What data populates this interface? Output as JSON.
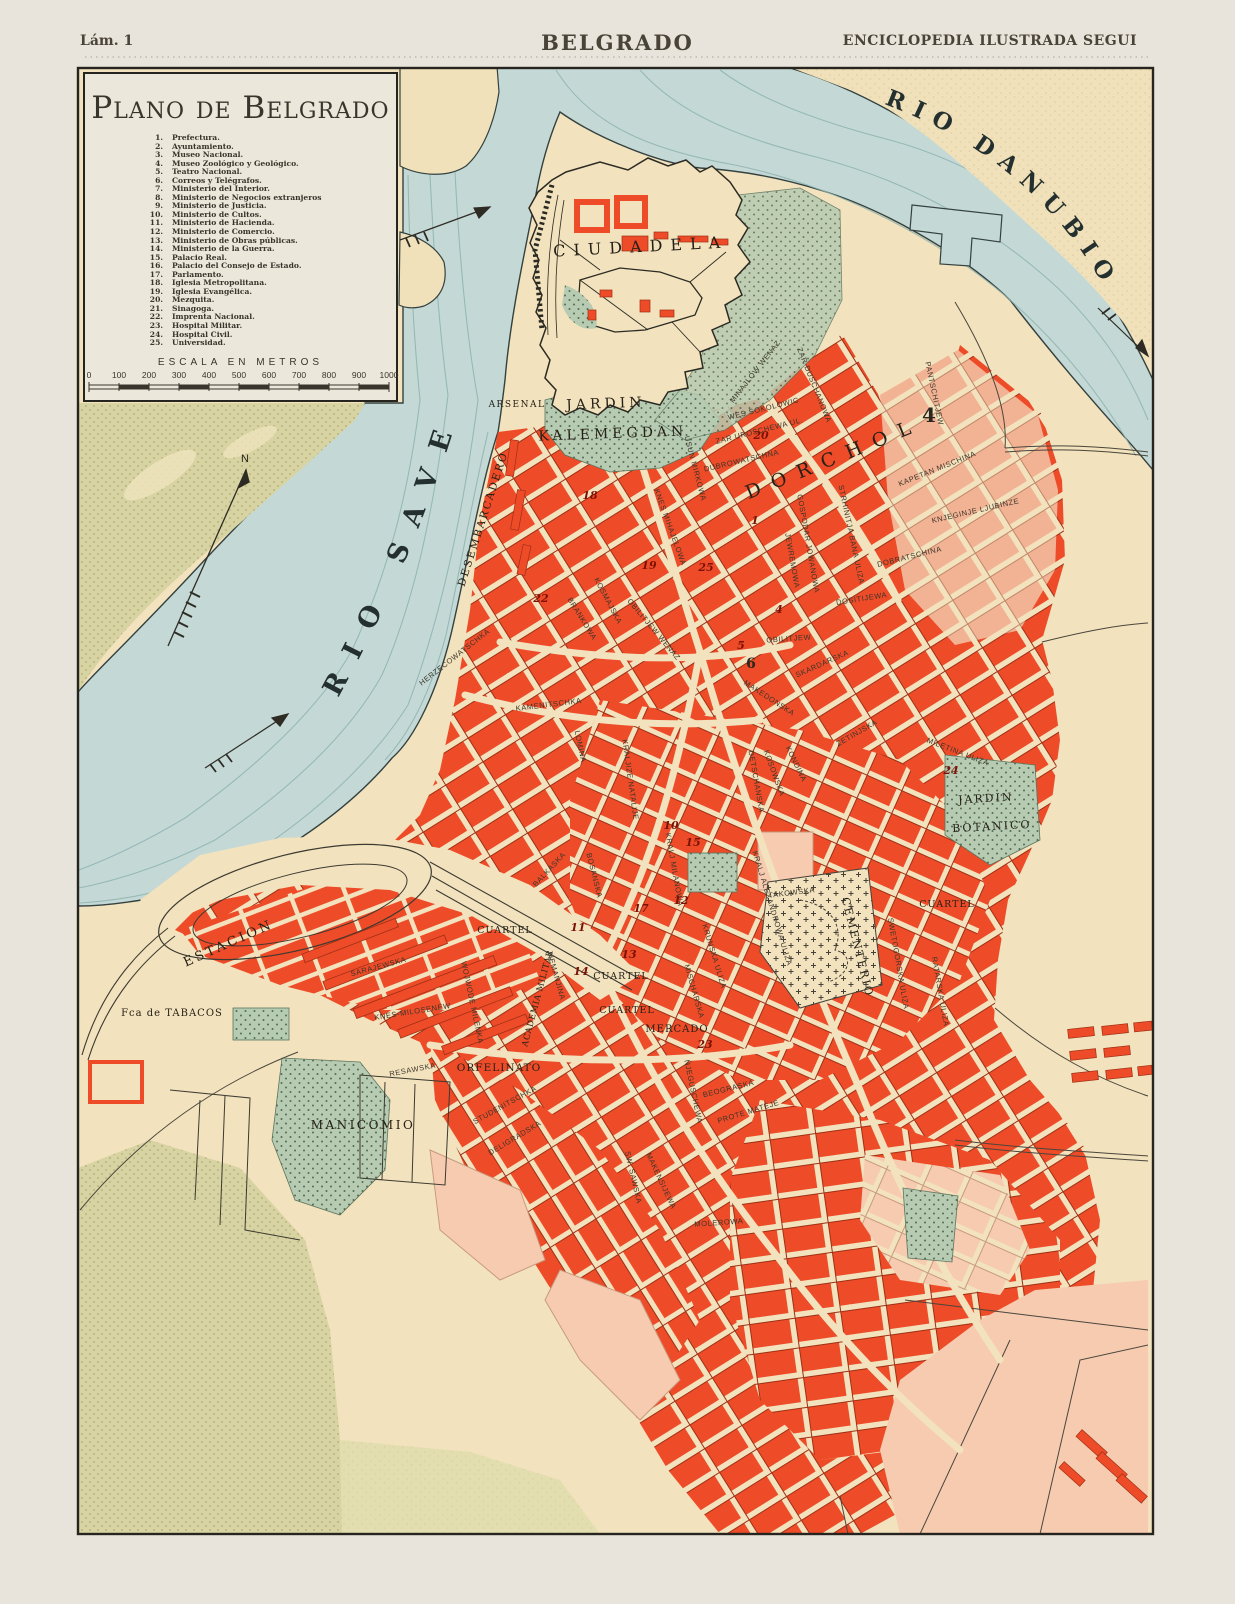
{
  "header": {
    "plate_label": "Lám. 1",
    "title": "BELGRADO",
    "publisher": "ENCICLOPEDIA ILUSTRADA SEGUI"
  },
  "legend": {
    "title": "Plano de Belgrado",
    "scale_title": "ESCALA EN METROS",
    "scale_ticks": [
      "0",
      "100",
      "200",
      "300",
      "400",
      "500",
      "600",
      "700",
      "800",
      "900",
      "1000"
    ],
    "items": [
      {
        "n": "1.",
        "t": "Prefectura."
      },
      {
        "n": "2.",
        "t": "Ayuntamiento."
      },
      {
        "n": "3.",
        "t": "Museo Nacional."
      },
      {
        "n": "4.",
        "t": "Museo Zoológico y Geológico."
      },
      {
        "n": "5.",
        "t": "Teatro Nacional."
      },
      {
        "n": "6.",
        "t": "Correos y Telégrafos."
      },
      {
        "n": "7.",
        "t": "Ministerio del Interior."
      },
      {
        "n": "8.",
        "t": "Ministerio de Negocios extranjeros"
      },
      {
        "n": "9.",
        "t": "Ministerio de Justicia."
      },
      {
        "n": "10.",
        "t": "Ministerio de Cultos."
      },
      {
        "n": "11.",
        "t": "Ministerio de Hacienda."
      },
      {
        "n": "12.",
        "t": "Ministerio de Comercio."
      },
      {
        "n": "13.",
        "t": "Ministerio de Obras públicas."
      },
      {
        "n": "14.",
        "t": "Ministerio de la Guerra."
      },
      {
        "n": "15.",
        "t": "Palacio Real."
      },
      {
        "n": "16.",
        "t": "Palacio del Consejo de Estado."
      },
      {
        "n": "17.",
        "t": "Parlamento."
      },
      {
        "n": "18.",
        "t": "Iglesia Metropolitana."
      },
      {
        "n": "19.",
        "t": "Iglesia Evangélica."
      },
      {
        "n": "20.",
        "t": "Mezquita."
      },
      {
        "n": "21.",
        "t": "Sinagoga."
      },
      {
        "n": "22.",
        "t": "Imprenta Nacional."
      },
      {
        "n": "23.",
        "t": "Hospital Militar."
      },
      {
        "n": "24.",
        "t": "Hospital Civil."
      },
      {
        "n": "25.",
        "t": "Universidad."
      }
    ]
  },
  "map": {
    "river_names": {
      "sava": "RIO SAVE",
      "danubio": "RIO DANUBIO"
    },
    "compass_north": "N",
    "colors": {
      "paper": "#e9e4db",
      "plate_land": "#f2e2bd",
      "water": "#c4d9d6",
      "water_line": "#8fb3b1",
      "block_red": "#ee4b28",
      "block_pink": "#f2b394",
      "block_pink_light": "#f6cbb0",
      "floodplain_olive": "#d8d3a2",
      "park_green": "#b5c9b0",
      "ink": "#26241e",
      "marker_red": "#7c1206"
    },
    "labels": [
      {
        "c": "p",
        "t": "CIUDADELA",
        "x": 641,
        "y": 252,
        "r": -3,
        "s": 16,
        "ls": 8
      },
      {
        "c": "p",
        "t": "ARSENAL",
        "x": 517,
        "y": 407,
        "r": 0,
        "s": 9,
        "ls": 1.5
      },
      {
        "c": "p",
        "t": "JARDIN",
        "x": 606,
        "y": 408,
        "r": -2,
        "s": 14,
        "ls": 4
      },
      {
        "c": "p",
        "t": "KALEMEGDAN",
        "x": 613,
        "y": 438,
        "r": -2,
        "s": 14,
        "ls": 4
      },
      {
        "c": "p",
        "t": "DESEMBARCADERO",
        "x": 486,
        "y": 520,
        "r": -72,
        "s": 10.5,
        "ls": 2
      },
      {
        "c": "p",
        "t": "ESTACION",
        "x": 230,
        "y": 947,
        "r": -24,
        "s": 13,
        "ls": 3
      },
      {
        "c": "p",
        "t": "Fca de TABACOS",
        "x": 172,
        "y": 1016,
        "r": 0,
        "s": 10,
        "ls": 1
      },
      {
        "c": "p",
        "t": "MANICOMIO",
        "x": 363,
        "y": 1129,
        "r": 0,
        "s": 12,
        "ls": 2.5
      },
      {
        "c": "p",
        "t": "ORFELINATO",
        "x": 499,
        "y": 1071,
        "r": 0,
        "s": 10.5,
        "ls": 1
      },
      {
        "c": "p",
        "t": "CUARTEL",
        "x": 505,
        "y": 933,
        "r": 0,
        "s": 9.5,
        "ls": 1
      },
      {
        "c": "p",
        "t": "CUARTEL",
        "x": 621,
        "y": 979,
        "r": 0,
        "s": 9.5,
        "ls": 1
      },
      {
        "c": "p",
        "t": "CUARTEL",
        "x": 627,
        "y": 1013,
        "r": 0,
        "s": 9.5,
        "ls": 1
      },
      {
        "c": "p",
        "t": "CUARTEL",
        "x": 947,
        "y": 907,
        "r": 0,
        "s": 9.5,
        "ls": 1
      },
      {
        "c": "p",
        "t": "MERCADO",
        "x": 677,
        "y": 1032,
        "r": 0,
        "s": 10,
        "ls": 1
      },
      {
        "c": "p",
        "t": "ACADEMIA MILITAR",
        "x": 540,
        "y": 999,
        "r": -75,
        "s": 8.5,
        "ls": 0.5
      },
      {
        "c": "p",
        "t": "CEMENTERIO",
        "x": 854,
        "y": 948,
        "r": 76,
        "s": 11,
        "ls": 2
      },
      {
        "c": "p",
        "t": "JARDIN",
        "x": 986,
        "y": 802,
        "r": -3,
        "s": 11,
        "ls": 2
      },
      {
        "c": "p",
        "t": "BOTANICO",
        "x": 992,
        "y": 830,
        "r": -3,
        "s": 11,
        "ls": 2
      },
      {
        "c": "p",
        "t": "DORCHOL",
        "x": 836,
        "y": 464,
        "r": -22,
        "s": 19,
        "ls": 12
      },
      {
        "c": "s",
        "t": "ZAR UROSCHEWA UL.",
        "x": 760,
        "y": 433,
        "r": -14
      },
      {
        "c": "s",
        "t": "DUBROWATSCHNA",
        "x": 742,
        "y": 463,
        "r": -13
      },
      {
        "c": "s",
        "t": "WES SOKOLOWIC",
        "x": 764,
        "y": 411,
        "r": -14
      },
      {
        "c": "s",
        "t": "ZAR DUSCHANOWA",
        "x": 812,
        "y": 386,
        "r": 68
      },
      {
        "c": "s",
        "t": "MINAJLOW WENAZ",
        "x": 757,
        "y": 373,
        "r": -52
      },
      {
        "c": "s",
        "t": "USUN MIRKOWA",
        "x": 693,
        "y": 469,
        "r": 75
      },
      {
        "c": "s",
        "t": "KNES MIHAJELOWA",
        "x": 668,
        "y": 528,
        "r": 70
      },
      {
        "c": "s",
        "t": "STRHINITJA BANA ULIZA",
        "x": 849,
        "y": 535,
        "r": 78
      },
      {
        "c": "s",
        "t": "GOSPODAR JOWANOWA",
        "x": 806,
        "y": 544,
        "r": 80
      },
      {
        "c": "s",
        "t": "JEWREMOWA",
        "x": 790,
        "y": 561,
        "r": 80
      },
      {
        "c": "s",
        "t": "KAPETAN MISCHINA",
        "x": 938,
        "y": 471,
        "r": -22
      },
      {
        "c": "s",
        "t": "PANTSCHITJEW",
        "x": 932,
        "y": 394,
        "r": 78
      },
      {
        "c": "s",
        "t": "KNJEGINJE LJUBINZE",
        "x": 976,
        "y": 513,
        "r": -13
      },
      {
        "c": "s",
        "t": "DOBRATSCHINA",
        "x": 910,
        "y": 559,
        "r": -14
      },
      {
        "c": "s",
        "t": "DOSITIJEWA",
        "x": 862,
        "y": 601,
        "r": -9
      },
      {
        "c": "s",
        "t": "OBILITJEW",
        "x": 789,
        "y": 641,
        "r": -4
      },
      {
        "c": "s",
        "t": "OBILITJEW WENAZ",
        "x": 652,
        "y": 631,
        "r": 50
      },
      {
        "c": "s",
        "t": "MAKEDONSKA",
        "x": 768,
        "y": 700,
        "r": 33
      },
      {
        "c": "s",
        "t": "KOSOWSKA",
        "x": 772,
        "y": 774,
        "r": 70
      },
      {
        "c": "s",
        "t": "KONDINA",
        "x": 794,
        "y": 765,
        "r": 64
      },
      {
        "c": "s",
        "t": "DETSCHANSKA",
        "x": 754,
        "y": 782,
        "r": 80
      },
      {
        "c": "s",
        "t": "ZETINJSKA",
        "x": 858,
        "y": 735,
        "r": -30
      },
      {
        "c": "s",
        "t": "SKARDARSKA",
        "x": 823,
        "y": 666,
        "r": -24
      },
      {
        "c": "s",
        "t": "KOSMAJSKA",
        "x": 606,
        "y": 602,
        "r": 62
      },
      {
        "c": "s",
        "t": "BRANKOWA",
        "x": 580,
        "y": 620,
        "r": 58
      },
      {
        "c": "s",
        "t": "KAMENITSCHKA",
        "x": 549,
        "y": 707,
        "r": -7
      },
      {
        "c": "s",
        "t": "LOMINA",
        "x": 578,
        "y": 747,
        "r": 78
      },
      {
        "c": "s",
        "t": "HERZECOWATSCHKA",
        "x": 456,
        "y": 659,
        "r": -38
      },
      {
        "c": "s",
        "t": "KRALJIZE NATALIJE",
        "x": 628,
        "y": 780,
        "r": 82
      },
      {
        "c": "s",
        "t": "KRALJ MILANOWA",
        "x": 672,
        "y": 870,
        "r": 80
      },
      {
        "c": "s",
        "t": "KRALJ ALEXANDROWA ULIZA",
        "x": 770,
        "y": 909,
        "r": 73
      },
      {
        "c": "s",
        "t": "NEMANJINA",
        "x": 554,
        "y": 977,
        "r": 74
      },
      {
        "c": "s",
        "t": "BALKASKA",
        "x": 551,
        "y": 871,
        "r": -47
      },
      {
        "c": "s",
        "t": "BOSANSKA",
        "x": 592,
        "y": 876,
        "r": 76
      },
      {
        "c": "s",
        "t": "SARAJEWSKA",
        "x": 379,
        "y": 969,
        "r": -15
      },
      {
        "c": "s",
        "t": "KNES-MILOSENEW",
        "x": 413,
        "y": 1014,
        "r": -9
      },
      {
        "c": "s",
        "t": "WOJWODE MILENKA",
        "x": 470,
        "y": 1003,
        "r": 78
      },
      {
        "c": "s",
        "t": "RESAWSKA",
        "x": 413,
        "y": 1072,
        "r": -11
      },
      {
        "c": "s",
        "t": "STUDENITSCHKA",
        "x": 506,
        "y": 1107,
        "r": -29
      },
      {
        "c": "s",
        "t": "DELIGRADSKA",
        "x": 516,
        "y": 1140,
        "r": -31
      },
      {
        "c": "s",
        "t": "MILETINA ULIZA",
        "x": 957,
        "y": 754,
        "r": 21
      },
      {
        "c": "s",
        "t": "RATARSKA ULIZA",
        "x": 938,
        "y": 992,
        "r": 80
      },
      {
        "c": "s",
        "t": "SWETOGORSKA ULIZA",
        "x": 896,
        "y": 964,
        "r": 80
      },
      {
        "c": "s",
        "t": "TAKOWSKA",
        "x": 792,
        "y": 895,
        "r": -7
      },
      {
        "c": "s",
        "t": "KRUNSKA ULIZA",
        "x": 712,
        "y": 957,
        "r": 73
      },
      {
        "c": "s",
        "t": "MISCHARSKA",
        "x": 692,
        "y": 992,
        "r": 74
      },
      {
        "c": "s",
        "t": "BEOGRASKA",
        "x": 729,
        "y": 1091,
        "r": -14
      },
      {
        "c": "s",
        "t": "PROTE MATEJE",
        "x": 749,
        "y": 1114,
        "r": -17
      },
      {
        "c": "s",
        "t": "NJEGUSCHEWA",
        "x": 691,
        "y": 1092,
        "r": 78
      },
      {
        "c": "s",
        "t": "SW. SAWSKA",
        "x": 631,
        "y": 1178,
        "r": 77
      },
      {
        "c": "s",
        "t": "MAKENSIJEWA",
        "x": 659,
        "y": 1182,
        "r": 65
      },
      {
        "c": "s",
        "t": "MOLEROWA",
        "x": 719,
        "y": 1225,
        "r": -4
      }
    ],
    "markers": [
      {
        "n": "1",
        "x": 755,
        "y": 524
      },
      {
        "n": "4",
        "x": 779,
        "y": 613
      },
      {
        "n": "4",
        "x": 929,
        "y": 422,
        "s": 20,
        "dark": true
      },
      {
        "n": "5",
        "x": 741,
        "y": 649
      },
      {
        "n": "6",
        "x": 751,
        "y": 668,
        "s": 14,
        "dark": true
      },
      {
        "n": "10",
        "x": 671,
        "y": 829
      },
      {
        "n": "11",
        "x": 578,
        "y": 931
      },
      {
        "n": "12",
        "x": 681,
        "y": 904
      },
      {
        "n": "13",
        "x": 629,
        "y": 958
      },
      {
        "n": "14",
        "x": 581,
        "y": 975
      },
      {
        "n": "15",
        "x": 693,
        "y": 846
      },
      {
        "n": "17",
        "x": 641,
        "y": 912
      },
      {
        "n": "18",
        "x": 590,
        "y": 499
      },
      {
        "n": "19",
        "x": 649,
        "y": 569
      },
      {
        "n": "20",
        "x": 761,
        "y": 439
      },
      {
        "n": "22",
        "x": 541,
        "y": 602
      },
      {
        "n": "23",
        "x": 705,
        "y": 1048
      },
      {
        "n": "24",
        "x": 951,
        "y": 774
      },
      {
        "n": "25",
        "x": 706,
        "y": 571
      }
    ]
  }
}
